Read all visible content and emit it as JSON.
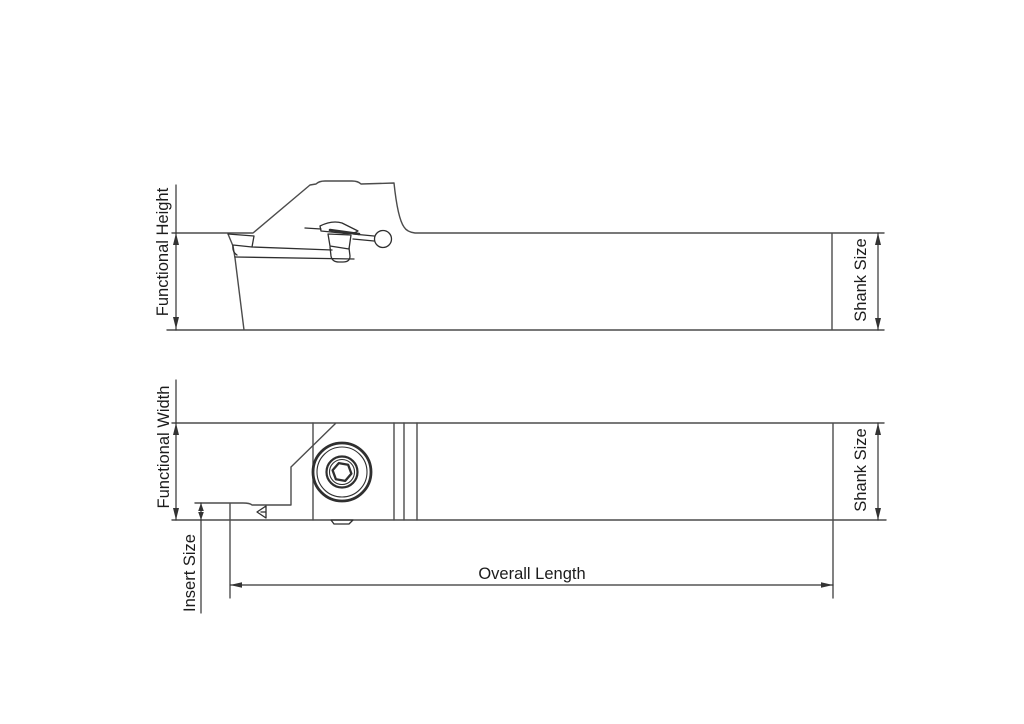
{
  "diagram": {
    "labels": {
      "functional_height": "Functional Height",
      "shank_size_top": "Shank Size",
      "functional_width": "Functional Width",
      "insert_size": "Insert Size",
      "shank_size_bottom": "Shank Size",
      "overall_length": "Overall Length"
    },
    "colors": {
      "background": "#ffffff",
      "outline": "#4c4c4c",
      "detail": "#2f2f2f",
      "dimension": "#333333",
      "text": "#1c1c1c"
    }
  }
}
